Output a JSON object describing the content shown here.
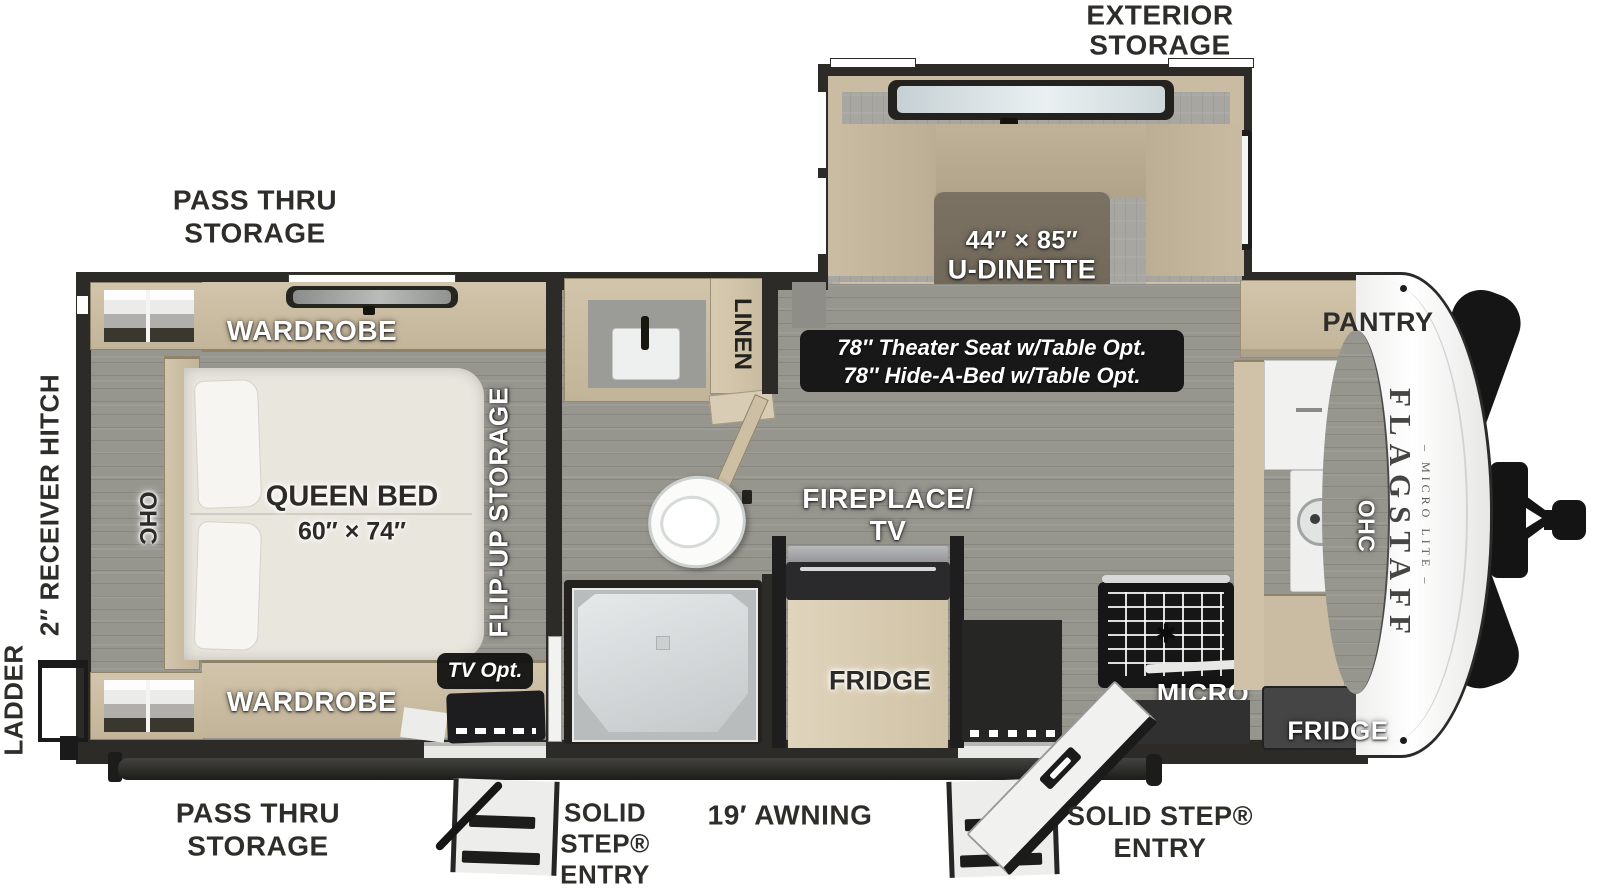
{
  "exterior": {
    "exterior_storage": [
      "EXTERIOR",
      "STORAGE"
    ],
    "pass_thru_top": [
      "PASS THRU",
      "STORAGE"
    ],
    "pass_thru_bottom": [
      "PASS THRU",
      "STORAGE"
    ],
    "awning": "19′ AWNING",
    "solid_step_left": [
      "SOLID",
      "STEP®",
      "ENTRY"
    ],
    "solid_step_right": [
      "SOLID STEP®",
      "ENTRY"
    ],
    "ladder": "LADDER",
    "receiver_hitch": "2″ RECEIVER HITCH"
  },
  "bedroom": {
    "wardrobe_top": "WARDROBE",
    "wardrobe_bottom": "WARDROBE",
    "bed_title": "QUEEN BED",
    "bed_size": "60″ × 74″",
    "ohc": "OHC",
    "flip_up": "FLIP-UP STORAGE",
    "tv_opt": "TV Opt."
  },
  "bathroom": {
    "linen": "LINEN"
  },
  "dinette": {
    "size": "44″ × 85″",
    "name": "U-DINETTE",
    "option_line1": "78″ Theater Seat w/Table Opt.",
    "option_line2": "78″ Hide-A-Bed w/Table Opt."
  },
  "kitchen": {
    "fireplace_tv": [
      "FIREPLACE/",
      "TV"
    ],
    "fridge_left": "FRIDGE",
    "fridge_right": "FRIDGE",
    "micro": "MICRO",
    "pantry": "PANTRY",
    "ohc": "OHC"
  },
  "brand": {
    "name": "FLAGSTAFF",
    "series": "– MICRO LITE –"
  },
  "colors": {
    "wall": "#2c2b28",
    "floor": "#96958e",
    "cabinet": "#cdc0a6",
    "dinette_table": "#756c5e",
    "badge": "#111113",
    "label_dark": "#2e2d2a"
  }
}
